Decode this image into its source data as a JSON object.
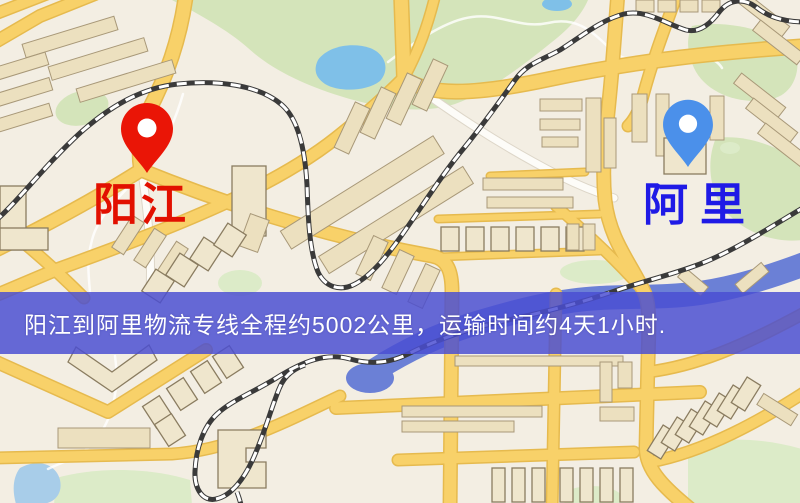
{
  "banner": {
    "text": "阳江到阿里物流专线全程约5002公里，运输时间约4天1小时.",
    "background": "#4a4ed2",
    "text_color": "#ffffff"
  },
  "markers": [
    {
      "id": "origin",
      "label": "阳江",
      "pin_color": "#ea1506",
      "label_color": "#e21000"
    },
    {
      "id": "destination",
      "label": "阿里",
      "pin_color": "#4b90ea",
      "label_color": "#1f1ae6"
    }
  ],
  "route": {
    "origin": "阳江",
    "destination": "阿里",
    "distance_km": 5002,
    "duration_text": "4天1小时"
  }
}
